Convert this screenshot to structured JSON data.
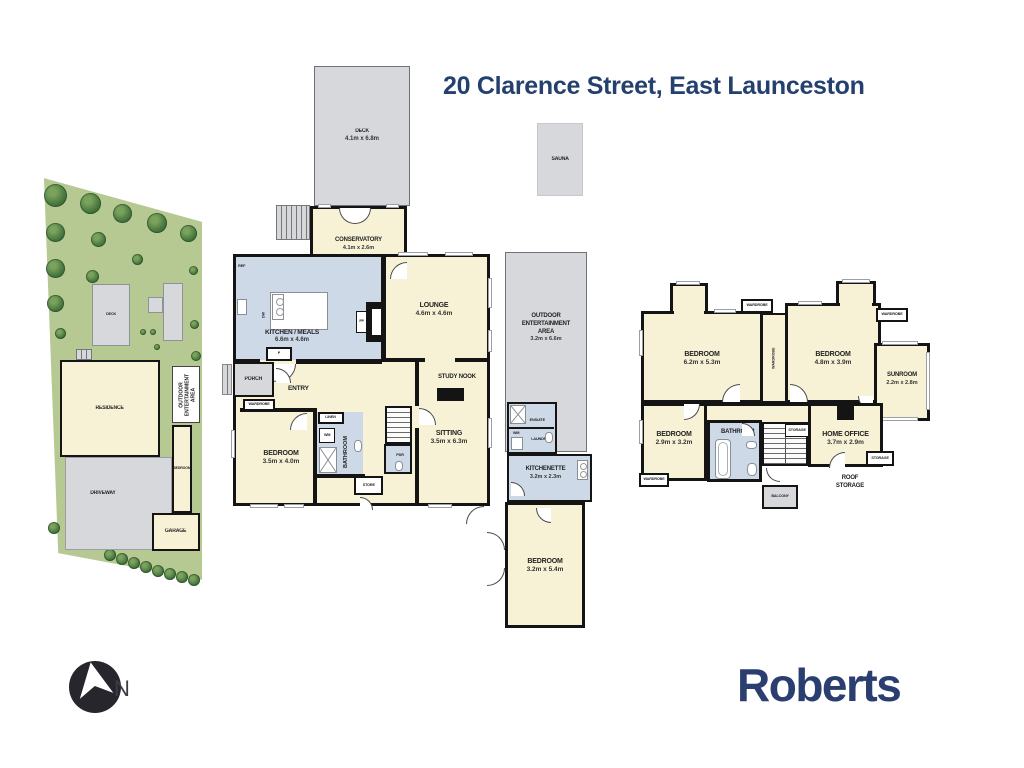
{
  "title": "20 Clarence Street, East Launceston",
  "branding": {
    "agency": "Roberts"
  },
  "compass": {
    "north": "N"
  },
  "sauna_label": "SAUNA",
  "site": {
    "deck": "DECK",
    "residence": "RESIDENCE",
    "outdoor_area": "OUTDOOR ENTERTAINMENT AREA",
    "bedroom": "BEDROOM",
    "driveway": "DRIVEWAY",
    "garage": "GARAGE"
  },
  "ground": {
    "deck": {
      "name": "DECK",
      "size": "4.1m x 6.8m"
    },
    "conservatory": {
      "name": "CONSERVATORY",
      "size": "4.1m x 2.6m"
    },
    "kitchen": {
      "name": "KITCHEN / MEALS",
      "size": "6.6m x 4.6m"
    },
    "lounge": {
      "name": "LOUNGE",
      "size": "4.6m x 4.6m"
    },
    "porch": "PORCH",
    "entry": "ENTRY",
    "wardrobe": "WARDROBE",
    "ref": "REF",
    "dw": "DW",
    "pantry": "P",
    "fp": "FP",
    "bedroom1": {
      "name": "BEDROOM",
      "size": "3.5m x 4.0m"
    },
    "linen": "LINEN",
    "wm": "WM",
    "bathroom": "BATHROOM",
    "store": "STORE",
    "pdr": "PDR",
    "sitting": {
      "name": "SITTING",
      "size": "3.5m x 6.3m"
    },
    "study_nook": "STUDY NOOK",
    "outdoor": {
      "line1": "OUTDOOR",
      "line2": "ENTERTAINMENT",
      "line3": "AREA",
      "size": "3.2m x 6.6m"
    },
    "ensuite": "ENSUITE",
    "wm2": "WM",
    "laundry": "LAUNDRY",
    "kitchenette": {
      "name": "KITCHENETTE",
      "size": "3.2m x 2.3m"
    },
    "bedroom2": {
      "name": "BEDROOM",
      "size": "3.2m x 5.4m"
    }
  },
  "upper": {
    "bedroom1": {
      "name": "BEDROOM",
      "size": "6.2m x 5.3m"
    },
    "bedroom2": {
      "name": "BEDROOM",
      "size": "4.8m x 3.9m"
    },
    "sunroom": {
      "name": "SUNROOM",
      "size": "2.2m x 2.8m"
    },
    "bedroom3": {
      "name": "BEDROOM",
      "size": "2.9m x 3.2m"
    },
    "bathroom": "BATHROOM",
    "home_office": {
      "name": "HOME OFFICE",
      "size": "3.7m x 2.9m"
    },
    "storage1": "STORAGE",
    "storage2": "STORAGE",
    "roof_storage": "ROOF STORAGE",
    "balcony": "BALCONY",
    "wardrobe_top": "WARDROBE",
    "wardrobe_mid": "WARDROBE",
    "wardrobe_right": "WARDROBE",
    "wardrobe_bottom": "WARDROBE"
  },
  "colors": {
    "navy": "#24406f",
    "cream": "#f7f2d6",
    "blue": "#cdd9e7",
    "grey": "#d6d8db",
    "green": "#b7c993",
    "wall": "#141414"
  }
}
